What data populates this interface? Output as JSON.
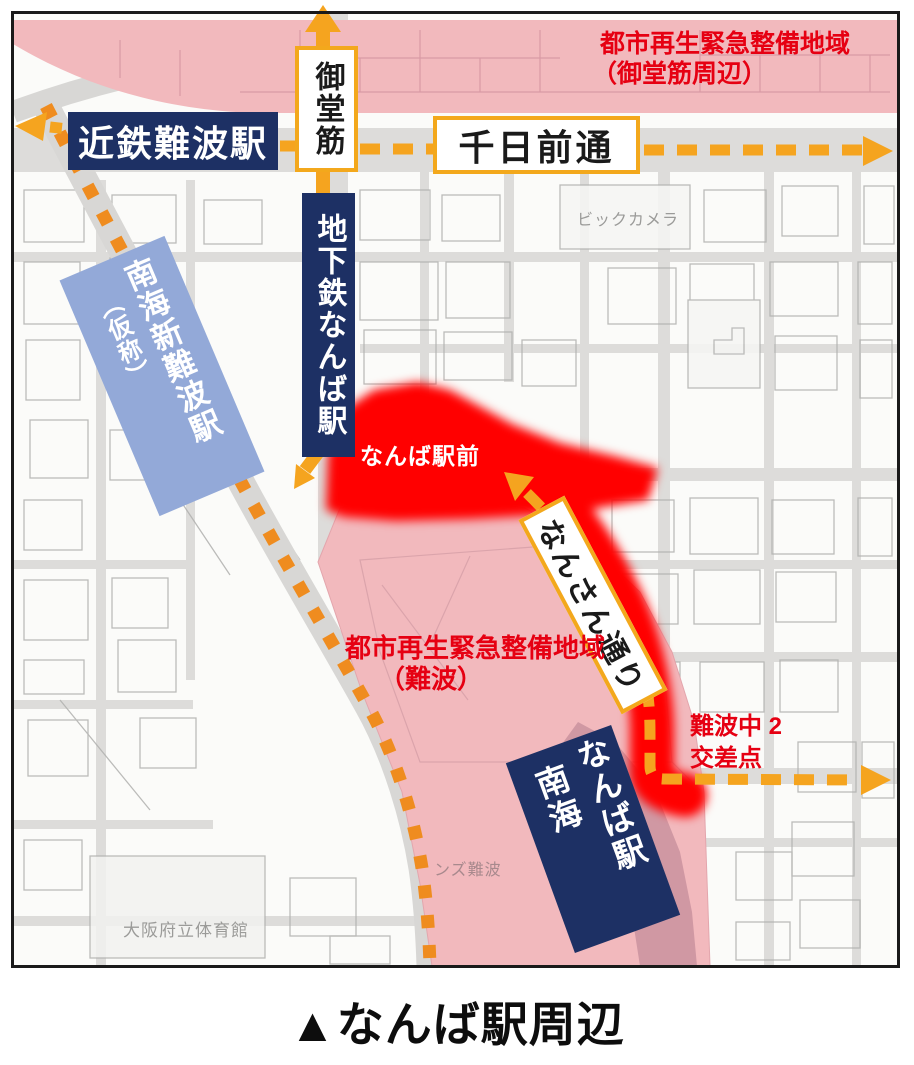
{
  "caption": "▲なんば駅周辺",
  "regions": {
    "udr_midosuji": {
      "line1": "都市再生緊急整備地域",
      "line2": "（御堂筋周辺）"
    },
    "udr_namba": {
      "line1": "都市再生緊急整備地域",
      "line2": "（難波）"
    }
  },
  "roads": {
    "sennichimae": "千日前通",
    "midosuji": "御堂筋",
    "nansan": "なんさん通り"
  },
  "stations": {
    "kintetsu_namba": "近鉄難波駅",
    "subway_namba": "地下鉄なんば駅",
    "nankai_shin_namba": {
      "paren": "（仮称）",
      "main": "南海新難波駅"
    },
    "nankai_namba": {
      "col1": "南海",
      "col2": "なんば駅"
    }
  },
  "points": {
    "namba_ekimae": "なんば駅前",
    "nambanaka_intersection": {
      "line1": "難波中 2",
      "line2": "交差点"
    }
  },
  "base_map_labels": {
    "bic_camera": "ビックカメラ",
    "osaka_pref_gym": "大阪府立体育館",
    "partial_building": "ンズ難波"
  },
  "colors": {
    "station_navy": "#1d3064",
    "planned_station_blue": "#93a9d8",
    "route_yellow": "#f5a41f",
    "railway_orange": "#ef8c1f",
    "red_text": "#e60012",
    "highlight_red": "#ff0000",
    "pink_zone": "#f2b9bd",
    "rose_strip": "#d098a3"
  }
}
